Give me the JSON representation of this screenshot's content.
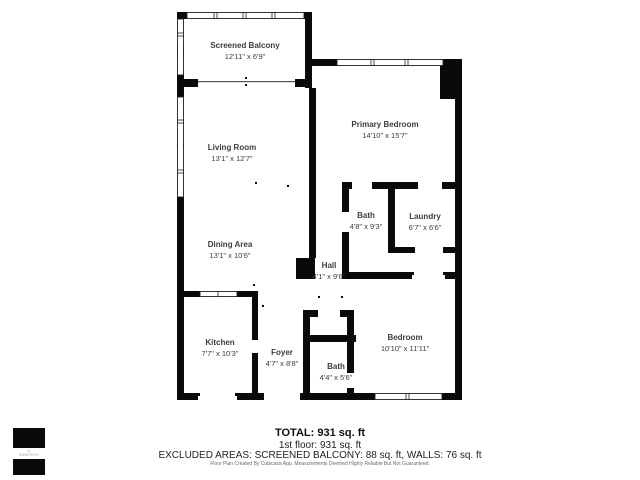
{
  "rooms": {
    "balcony": {
      "name": "Screened Balcony",
      "dims": "12'11\" x 6'9\""
    },
    "living": {
      "name": "Living Room",
      "dims": "13'1\" x 12'7\""
    },
    "primary": {
      "name": "Primary Bedroom",
      "dims": "14'10\" x 15'7\""
    },
    "bath1": {
      "name": "Bath",
      "dims": "4'8\" x 9'3\""
    },
    "laundry": {
      "name": "Laundry",
      "dims": "6'7\" x 6'6\""
    },
    "dining": {
      "name": "Dining Area",
      "dims": "13'1\" x 10'6\""
    },
    "hall": {
      "name": "Hall",
      "dims": "4'1\" x 9'6\""
    },
    "kitchen": {
      "name": "Kitchen",
      "dims": "7'7\" x 10'3\""
    },
    "foyer": {
      "name": "Foyer",
      "dims": "4'7\" x 8'8\""
    },
    "bath2": {
      "name": "Bath",
      "dims": "4'4\" x 5'6\""
    },
    "bedroom": {
      "name": "Bedroom",
      "dims": "10'10\" x 11'11\""
    }
  },
  "summary": {
    "total": "TOTAL: 931 sq. ft",
    "floor1": "1st floor: 931 sq. ft",
    "excluded": "EXCLUDED AREAS: SCREENED BALCONY: 88 sq. ft, WALLS: 76 sq. ft",
    "disclaimer": "Floor Plan Created By Cubicasa App. Measurements Deemed Highly Reliable But Not Guaranteed."
  },
  "logo": {
    "text": "SMARTPIX"
  },
  "colors": {
    "wall": "#0a0a0a",
    "label_text": "#3c3c3c"
  }
}
